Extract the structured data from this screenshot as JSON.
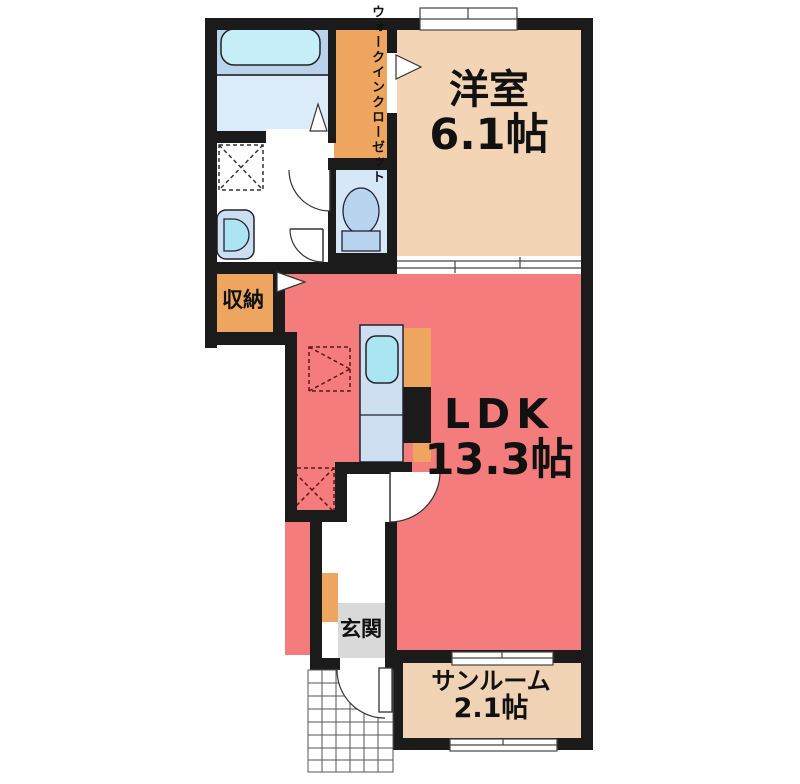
{
  "floorplan": {
    "rooms": {
      "western_room": {
        "label": "洋室",
        "size": "6.1帖"
      },
      "ldk": {
        "label": "LDK",
        "size": "13.3帖"
      },
      "sunroom": {
        "label": "サンルーム",
        "size": "2.1帖"
      },
      "walk_in_closet": {
        "label_col_right": "ウォークイン",
        "label_col_left": "クローゼット"
      },
      "storage": {
        "label": "収納"
      },
      "entrance": {
        "label": "玄関"
      }
    },
    "colors": {
      "wall": "#1b1b1b",
      "western_room_floor": "#f3d5b5",
      "sunroom_floor": "#f0d2b4",
      "ldk_floor": "#f47c7c",
      "closet_storage": "#eda55f",
      "bathroom_upper": "#b9d4ea",
      "bathroom_lower": "#dcebf8",
      "bathtub": "#c5eef8",
      "toilet_room": "#d6e7f8",
      "kitchen_counter": "#cfdff2",
      "sink": "#aae6f2",
      "entrance_floor": "#d9d9d9"
    }
  }
}
